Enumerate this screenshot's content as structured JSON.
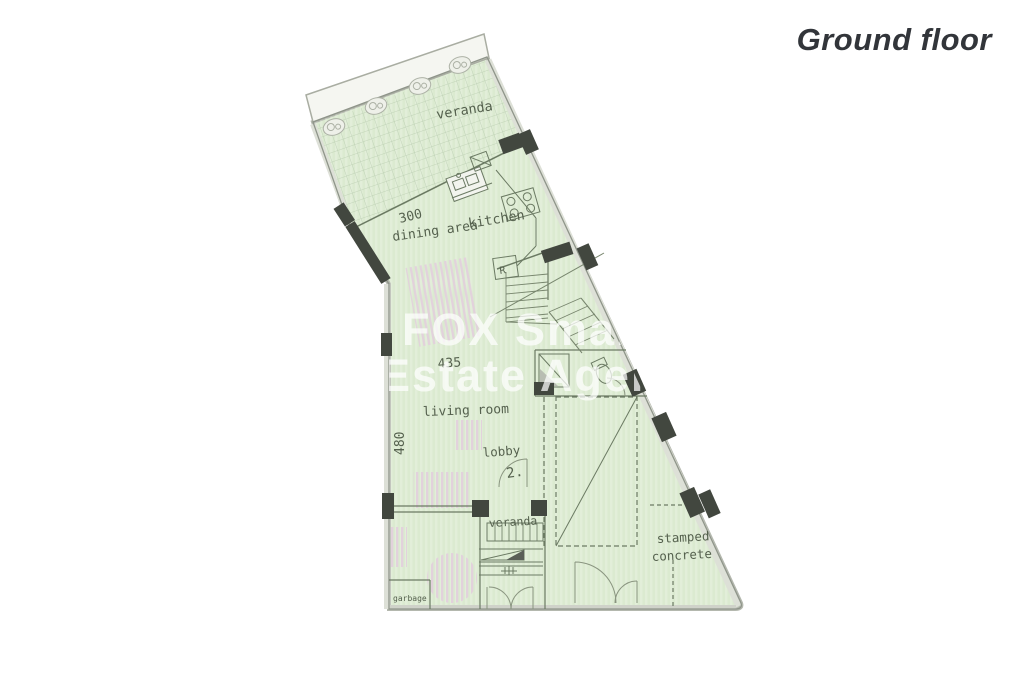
{
  "header": {
    "title": "Ground floor"
  },
  "watermark": {
    "line1": "FOX Smart",
    "line2": "Estate Agency"
  },
  "rooms": {
    "veranda_top": "veranda",
    "dining_area": "dining area",
    "kitchen": "kitchen",
    "living_room": "living room",
    "lobby": "lobby",
    "lobby_number": "2.",
    "veranda_lower": "veranda",
    "garbage": "garbage",
    "stamped_concrete_line1": "stamped",
    "stamped_concrete_line2": "concrete"
  },
  "dimensions": {
    "dining_width": "300",
    "living_width": "435",
    "living_height": "480"
  },
  "fixtures": {
    "fridge": "R"
  },
  "colors": {
    "floor_fill": "#dbead0",
    "tile_line": "#b9cdb0",
    "interior_line": "#6b7a63",
    "wall_marker": "#42473f",
    "furniture_pink": "#e3cfdd",
    "outline_gray": "#9aa094",
    "title_text": "#32353a",
    "watermark_text": "#ffffff"
  }
}
